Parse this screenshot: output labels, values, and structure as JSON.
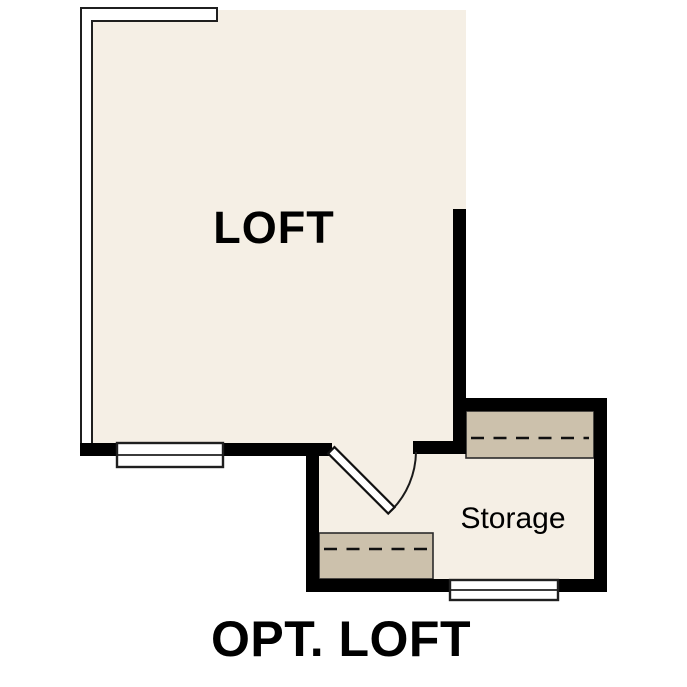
{
  "plan": {
    "caption": "OPT. LOFT",
    "rooms": {
      "loft": {
        "label": "LOFT"
      },
      "storage": {
        "label": "Storage"
      }
    }
  },
  "colors": {
    "background": "#ffffff",
    "room_fill": "#f5efe5",
    "cabinet_fill": "#ccc1ac",
    "wall": "#000000",
    "label_text": "#000000"
  }
}
